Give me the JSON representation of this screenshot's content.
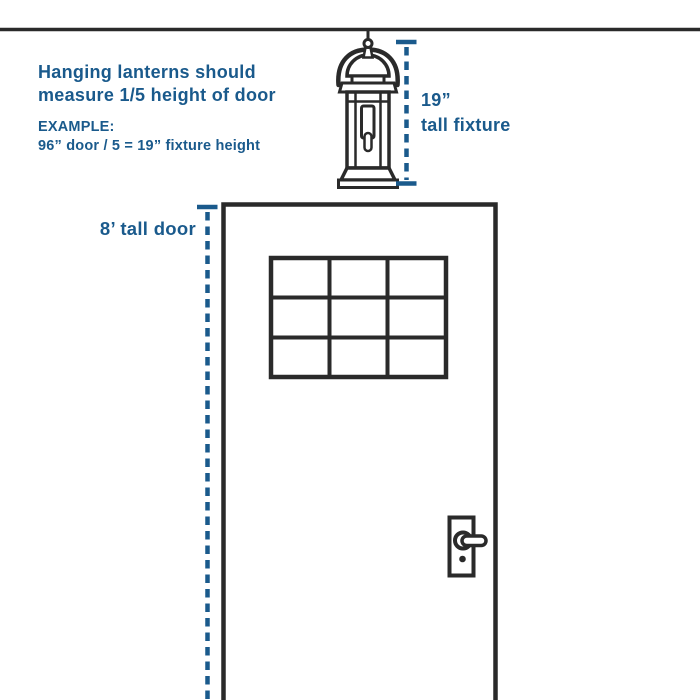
{
  "canvas": {
    "width": 700,
    "height": 700,
    "background": "#FFFFFF"
  },
  "colors": {
    "accent_blue": "#1A5A8C",
    "line_ink": "#2A2A2A"
  },
  "note": {
    "line1": "Hanging lanterns should",
    "line2": "measure 1/5 height of door"
  },
  "example": {
    "label": "EXAMPLE:",
    "formula": "96” door / 5 = 19” fixture height"
  },
  "fixture_dimension": {
    "value": "19”",
    "caption": "tall fixture"
  },
  "door_dimension": {
    "label": "8’ tall door"
  },
  "icons": {
    "ceiling": "ceiling-line",
    "lantern": "hanging-lantern-icon",
    "fixture_measure": "fixture-height-dimension-line",
    "door_measure": "door-height-dimension-line",
    "door": "door-outline",
    "window": "door-window-grid",
    "handle": "door-handle-icon"
  }
}
